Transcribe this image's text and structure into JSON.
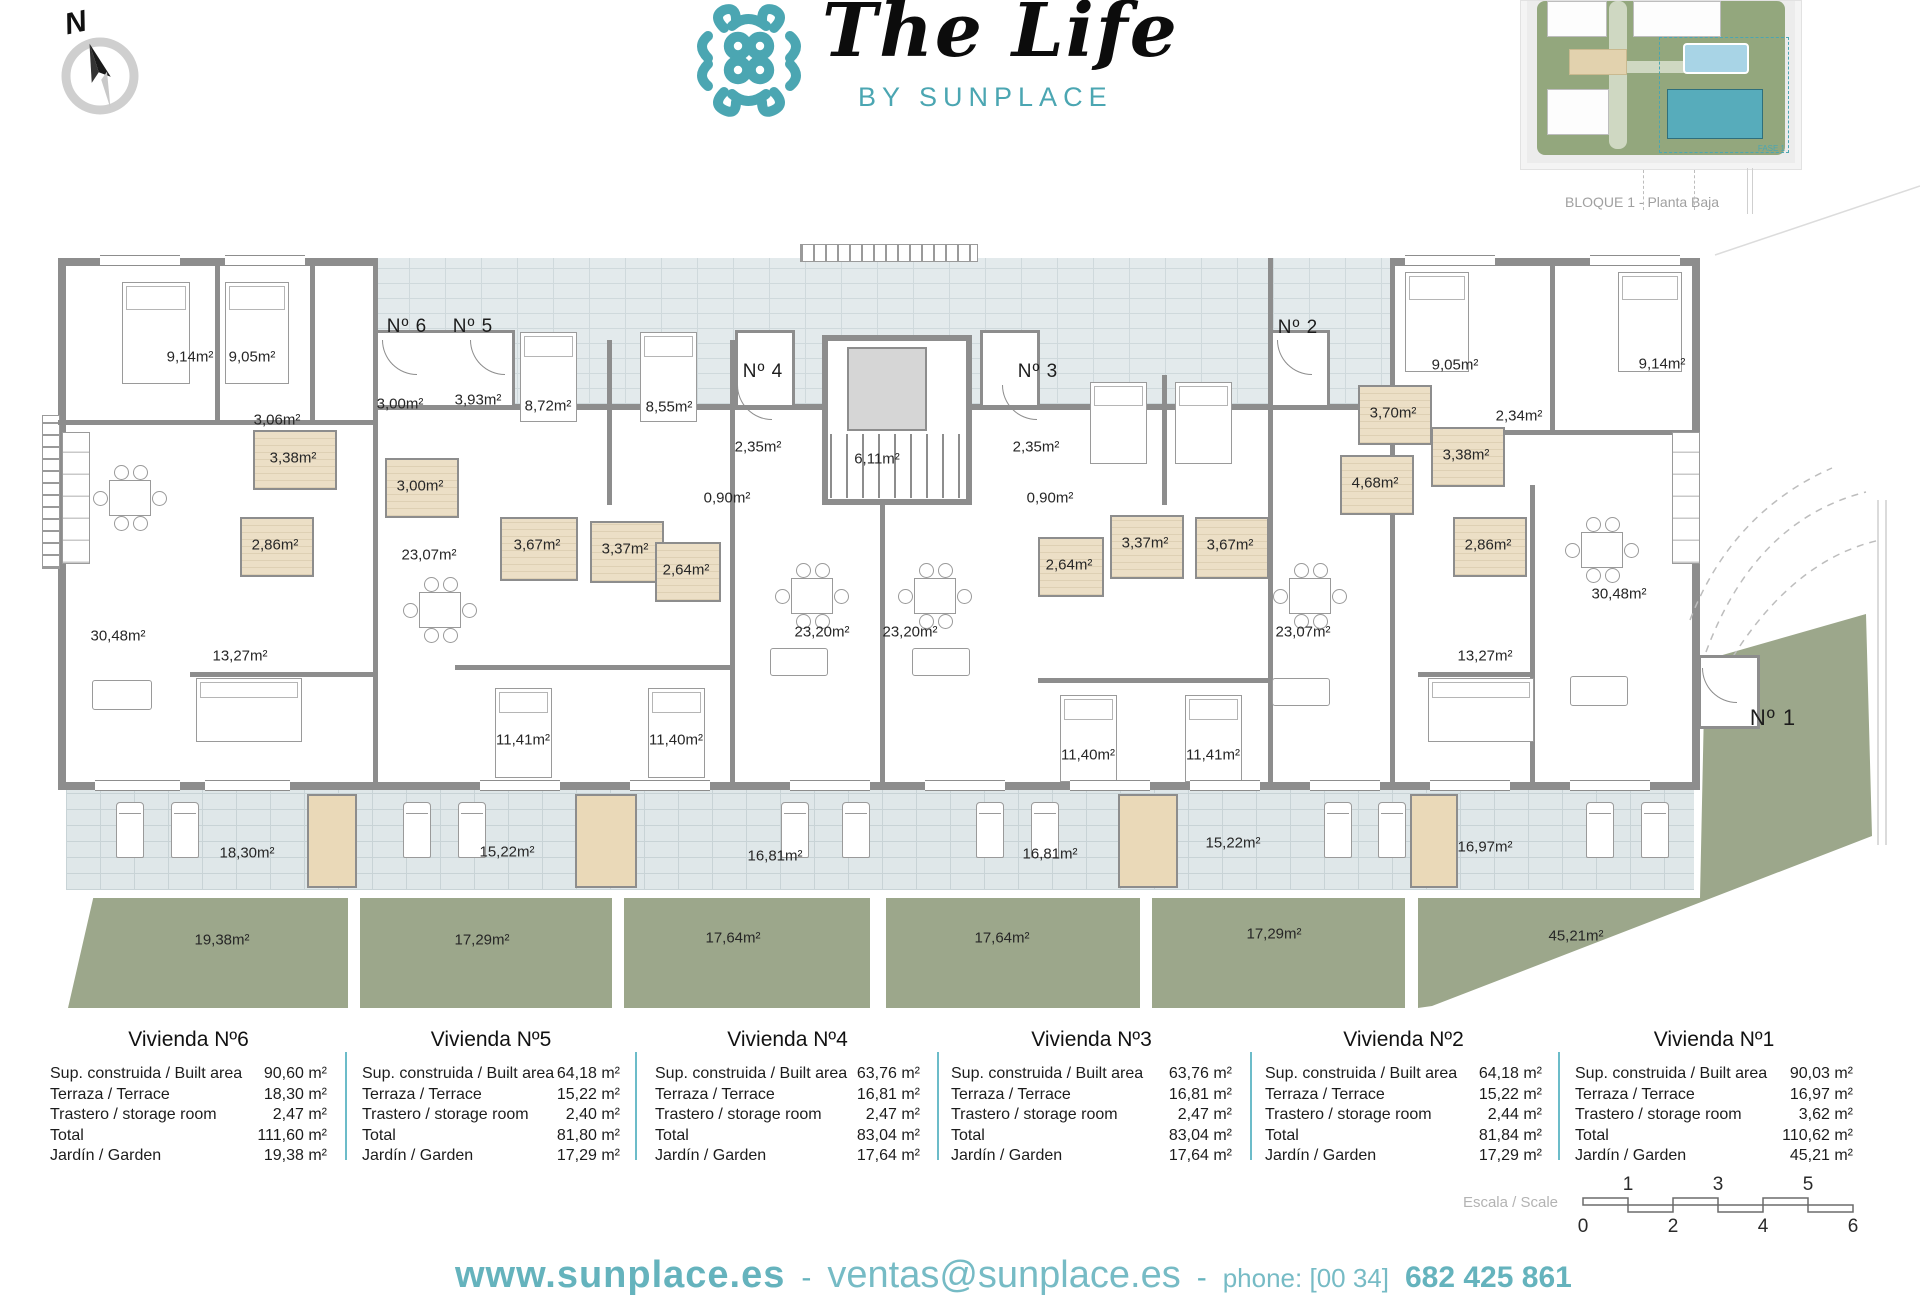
{
  "header": {
    "brand_title": "The Life",
    "brand_subtitle": "BY SUNPLACE",
    "compass_letter": "N",
    "block_label": "BLOQUE 1 - Planta Baja",
    "minimap_zone_label": "FASE 1"
  },
  "colors": {
    "accent_teal": "#4ba6b2",
    "garden_green": "#9ca78b",
    "terrace_brick": "#dfe7e9",
    "wall_gray": "#8d8d8d",
    "bath_beige": "#ecdfc6",
    "table_divider": "#6cbcc9"
  },
  "plan": {
    "unit_labels": [
      {
        "text": "Nº 6",
        "x": 407,
        "y": 327
      },
      {
        "text": "Nº 5",
        "x": 473,
        "y": 327
      },
      {
        "text": "Nº 4",
        "x": 763,
        "y": 372
      },
      {
        "text": "Nº 3",
        "x": 1038,
        "y": 372
      },
      {
        "text": "Nº 2",
        "x": 1298,
        "y": 328
      },
      {
        "text": "Nº 1",
        "x": 1773,
        "y": 718,
        "big": true
      }
    ],
    "area_labels": [
      {
        "text": "9,14m²",
        "x": 190,
        "y": 357
      },
      {
        "text": "9,05m²",
        "x": 252,
        "y": 357
      },
      {
        "text": "3,06m²",
        "x": 277,
        "y": 420
      },
      {
        "text": "3,00m²",
        "x": 400,
        "y": 404
      },
      {
        "text": "3,93m²",
        "x": 478,
        "y": 400
      },
      {
        "text": "8,72m²",
        "x": 548,
        "y": 406
      },
      {
        "text": "8,55m²",
        "x": 669,
        "y": 407
      },
      {
        "text": "2,35m²",
        "x": 758,
        "y": 447
      },
      {
        "text": "6,11m²",
        "x": 877,
        "y": 459
      },
      {
        "text": "2,35m²",
        "x": 1036,
        "y": 447
      },
      {
        "text": "0,90m²",
        "x": 727,
        "y": 498
      },
      {
        "text": "0,90m²",
        "x": 1050,
        "y": 498
      },
      {
        "text": "3,38m²",
        "x": 293,
        "y": 458
      },
      {
        "text": "3,00m²",
        "x": 420,
        "y": 486
      },
      {
        "text": "3,70m²",
        "x": 1393,
        "y": 413
      },
      {
        "text": "9,05m²",
        "x": 1455,
        "y": 365
      },
      {
        "text": "9,14m²",
        "x": 1662,
        "y": 364
      },
      {
        "text": "2,34m²",
        "x": 1519,
        "y": 416
      },
      {
        "text": "3,38m²",
        "x": 1466,
        "y": 455
      },
      {
        "text": "4,68m²",
        "x": 1375,
        "y": 483
      },
      {
        "text": "2,86m²",
        "x": 275,
        "y": 545
      },
      {
        "text": "3,67m²",
        "x": 537,
        "y": 545
      },
      {
        "text": "3,37m²",
        "x": 625,
        "y": 549
      },
      {
        "text": "2,64m²",
        "x": 686,
        "y": 570
      },
      {
        "text": "2,64m²",
        "x": 1069,
        "y": 565
      },
      {
        "text": "3,37m²",
        "x": 1145,
        "y": 543
      },
      {
        "text": "3,67m²",
        "x": 1230,
        "y": 545
      },
      {
        "text": "2,86m²",
        "x": 1488,
        "y": 545
      },
      {
        "text": "23,07m²",
        "x": 429,
        "y": 555
      },
      {
        "text": "23,20m²",
        "x": 822,
        "y": 632
      },
      {
        "text": "23,20m²",
        "x": 910,
        "y": 632
      },
      {
        "text": "23,07m²",
        "x": 1303,
        "y": 632
      },
      {
        "text": "30,48m²",
        "x": 118,
        "y": 636
      },
      {
        "text": "30,48m²",
        "x": 1619,
        "y": 594
      },
      {
        "text": "13,27m²",
        "x": 240,
        "y": 656
      },
      {
        "text": "13,27m²",
        "x": 1485,
        "y": 656
      },
      {
        "text": "11,41m²",
        "x": 523,
        "y": 740
      },
      {
        "text": "11,40m²",
        "x": 676,
        "y": 740
      },
      {
        "text": "11,40m²",
        "x": 1088,
        "y": 755
      },
      {
        "text": "11,41m²",
        "x": 1213,
        "y": 755
      }
    ],
    "terrace_labels": [
      {
        "text": "18,30m²",
        "x": 247,
        "y": 853
      },
      {
        "text": "15,22m²",
        "x": 507,
        "y": 852
      },
      {
        "text": "16,81m²",
        "x": 775,
        "y": 856
      },
      {
        "text": "16,81m²",
        "x": 1050,
        "y": 854
      },
      {
        "text": "15,22m²",
        "x": 1233,
        "y": 843
      },
      {
        "text": "16,97m²",
        "x": 1485,
        "y": 847
      }
    ],
    "garden_labels": [
      {
        "text": "19,38m²",
        "x": 222,
        "y": 940
      },
      {
        "text": "17,29m²",
        "x": 482,
        "y": 940
      },
      {
        "text": "17,64m²",
        "x": 733,
        "y": 938
      },
      {
        "text": "17,64m²",
        "x": 1002,
        "y": 938
      },
      {
        "text": "17,29m²",
        "x": 1274,
        "y": 934
      },
      {
        "text": "45,21m²",
        "x": 1576,
        "y": 936
      }
    ]
  },
  "table": {
    "row_labels": [
      "Sup. construida / Built area",
      "Terraza / Terrace",
      "Trastero / storage room",
      "Total",
      "Jardín / Garden"
    ],
    "units": [
      {
        "name": "Vivienda Nº6",
        "values": [
          "90,60 m²",
          "18,30 m²",
          "2,47 m²",
          "111,60 m²",
          "19,38 m²"
        ]
      },
      {
        "name": "Vivienda Nº5",
        "values": [
          "64,18 m²",
          "15,22 m²",
          "2,40 m²",
          "81,80 m²",
          "17,29 m²"
        ]
      },
      {
        "name": "Vivienda Nº4",
        "values": [
          "63,76 m²",
          "16,81 m²",
          "2,47 m²",
          "83,04 m²",
          "17,64 m²"
        ]
      },
      {
        "name": "Vivienda Nº3",
        "values": [
          "63,76 m²",
          "16,81 m²",
          "2,47 m²",
          "83,04 m²",
          "17,64 m²"
        ]
      },
      {
        "name": "Vivienda Nº2",
        "values": [
          "64,18 m²",
          "15,22 m²",
          "2,44 m²",
          "81,84 m²",
          "17,29 m²"
        ]
      },
      {
        "name": "Vivienda Nº1",
        "values": [
          "90,03 m²",
          "16,97 m²",
          "3,62 m²",
          "110,62 m²",
          "45,21 m²"
        ]
      }
    ]
  },
  "scale_bar": {
    "label": "Escala / Scale",
    "top_ticks": [
      "1",
      "3",
      "5"
    ],
    "bottom_ticks": [
      "0",
      "2",
      "4",
      "6"
    ]
  },
  "footer": {
    "website": "www.sunplace.es",
    "separator": "-",
    "email": "ventas@sunplace.es",
    "phone_label": "phone: [00 34]",
    "phone_number": "682 425 861"
  }
}
